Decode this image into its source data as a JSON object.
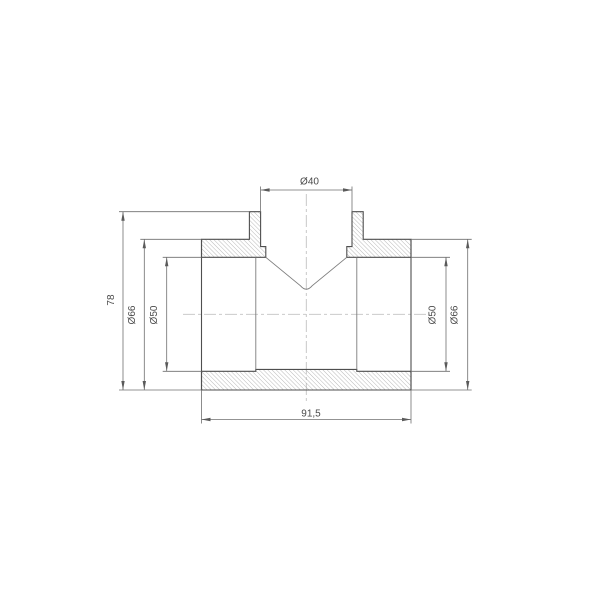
{
  "drawing": {
    "type": "technical_drawing_cross_section",
    "subject": "tee-pipe-fitting",
    "view": "front-section-view",
    "labels": {
      "branch_inner_diameter": "Ø40",
      "total_height": "78",
      "body_outer_diameter_left": "Ø66",
      "body_inner_diameter_left": "Ø50",
      "body_inner_diameter_right": "Ø50",
      "body_outer_diameter_right": "Ø66",
      "body_length": "91,5"
    },
    "colors": {
      "outline": "#4f4f4f",
      "dimension_lines": "#6f6f6f",
      "hatch": "#a8a8a8",
      "centerline": "#c2c2c2",
      "text": "#4a4a4a",
      "background": "#ffffff"
    }
  }
}
